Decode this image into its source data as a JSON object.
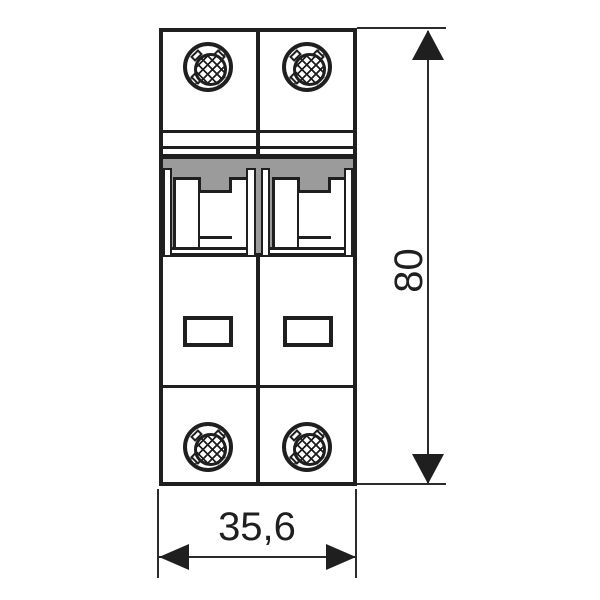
{
  "diagram": {
    "subject": "Two-pole miniature circuit breaker, front view technical drawing",
    "pole_count": 2,
    "dimensions": {
      "height_mm": "80",
      "width_mm": "35,6"
    },
    "colors": {
      "line": "#1f1f1f",
      "recess_gray": "#9b9b9b",
      "background": "#ffffff"
    },
    "components": {
      "screw_terminals": 4,
      "toggle_handles": 2,
      "indicator_windows": 2
    }
  }
}
